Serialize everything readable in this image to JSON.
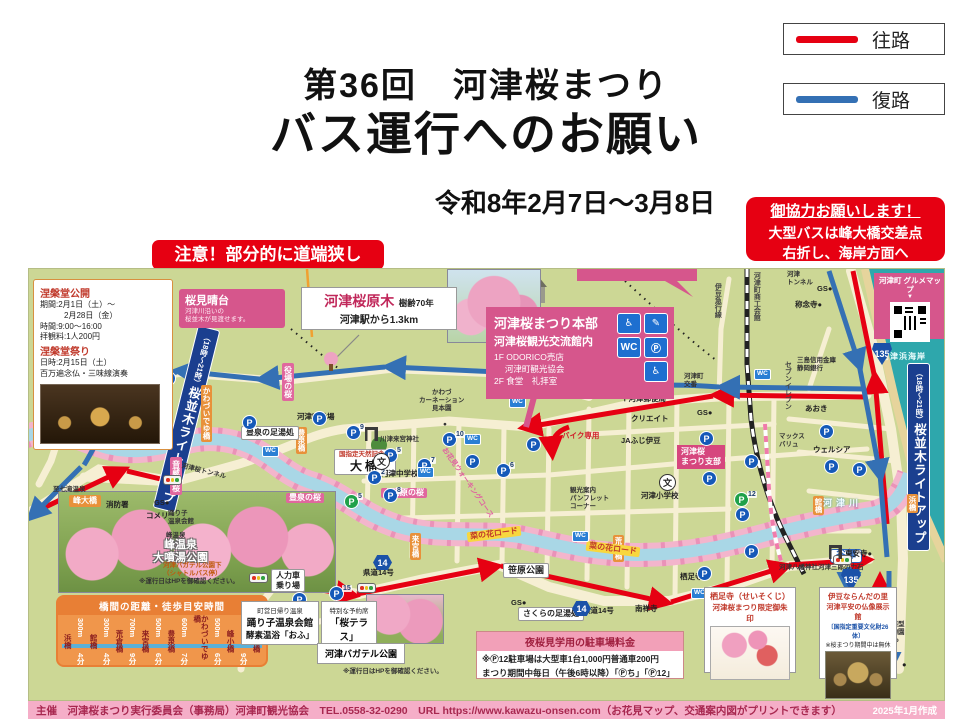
{
  "header": {
    "title_line1": "第36回　河津桜まつり",
    "title_line2": "バス運行へのお願い",
    "period": "令和8年2月7日～3月8日",
    "legend": [
      {
        "label": "往路",
        "color": "#e60012"
      },
      {
        "label": "復路",
        "color": "#3470b4"
      }
    ],
    "notice_right_line1": "御協力お願いします！",
    "notice_right_line2": "大型バスは峰大橋交差点",
    "notice_right_line3": "右折し、海岸方面へ",
    "notice_left": "注意！部分的に道端狭し"
  },
  "map": {
    "parking_glyph": "P",
    "wc_glyph": "WC",
    "school_glyph": "文",
    "route_out_color": "#e60012",
    "route_back_color": "#3470b4",
    "nehando": {
      "title1": "涅槃堂公開",
      "body1": "期間:2月1日（土）～\n　　　2月28日（金）\n時間:9:00～16:00\n拝観料:1人200円",
      "title2": "涅槃堂祭り",
      "body2": "日時:2月15日（土）\n百万遍念仏・三味線演奏"
    },
    "miharashi": {
      "title": "桜見晴台",
      "sub": "河津川沿いの\n桜並木が見渡せます。"
    },
    "genboku": {
      "name": "河津桜原木",
      "age": "樹齢70年",
      "sub": "河津駅から1.3km"
    },
    "hombu": {
      "line1": "河津桜まつり本部",
      "line2": "河津桜観光交流館内",
      "line3": "1F ODORICO売店\n　 河津町観光協会\n2F 食堂　礼拝室",
      "icons": [
        {
          "g": "♿"
        },
        {
          "g": "✎"
        },
        {
          "g": "WC"
        },
        {
          "g": "Ⓟ"
        },
        {
          "g": "♿"
        }
      ]
    },
    "gurume": {
      "title": "河津町\nグルメマップ",
      "arrow": "▼"
    },
    "feebox": {
      "header": "夜桜見学用の駐車場料金",
      "line1": "※Ⓟ12駐車場は大型車1台1,000円普通車200円",
      "line2": "まつり期間中毎日（午後6時以降）「Ⓟち」「Ⓟ12」"
    },
    "seisokuji": {
      "line1": "栖足寺（せいそくじ）",
      "line2": "河津桜まつり限定御朱印"
    },
    "naranda": {
      "line1": "伊豆ならんだの里",
      "line2": "河津平安の仏像展示館",
      "line3": "〔国指定重要文化財26体〕",
      "line4": "※桜まつり期間中は無休"
    },
    "odoriko": {
      "line1": "町営日帰り温泉",
      "line2": "踊り子温泉会館",
      "line3": "酵素温浴「おふ」"
    },
    "terrace": {
      "line1": "特別な予約席",
      "line2": "「桜テラス」"
    },
    "bagatel_label": "河津バガテル公園",
    "labels": [
      {
        "t": "涅槃堂",
        "x": 112,
        "y": 74,
        "cls": "vplain"
      },
      {
        "pre": "（18時～21時）",
        "t": "桜並木ライトアップ",
        "x": 146,
        "y": 56,
        "cls": "bluebox",
        "rot": "rotate(14deg)"
      },
      {
        "pre": "（18時～21時）",
        "t": "桜並木ライトアップ",
        "x": 878,
        "y": 94,
        "cls": "bluebox"
      },
      {
        "t": "峰小橋",
        "x": 20,
        "y": 157,
        "cls": "orangeh"
      },
      {
        "t": "峰大橋",
        "x": 40,
        "y": 226,
        "cls": "orangeh"
      },
      {
        "t": "かわづいでゆ橋",
        "x": 172,
        "y": 116,
        "cls": "orangev"
      },
      {
        "t": "豊泉橋",
        "x": 267,
        "y": 158,
        "cls": "orangev"
      },
      {
        "t": "来宮橋",
        "x": 381,
        "y": 264,
        "cls": "orangev"
      },
      {
        "t": "荒倉橋",
        "x": 584,
        "y": 266,
        "cls": "orangev"
      },
      {
        "t": "館橋",
        "x": 784,
        "y": 227,
        "cls": "orangev"
      },
      {
        "t": "浜橋",
        "x": 878,
        "y": 225,
        "cls": "orangev"
      },
      {
        "t": "役場の桜",
        "x": 253,
        "y": 94,
        "cls": "pinkv"
      },
      {
        "t": "音蔵の桜",
        "x": 141,
        "y": 188,
        "cls": "pinkv"
      },
      {
        "t": "上河原の桜",
        "x": 352,
        "y": 219,
        "cls": "pinkh"
      },
      {
        "t": "豊泉の桜",
        "x": 257,
        "y": 224,
        "cls": "pinkh"
      },
      {
        "t": "河津桜\nまつり支部",
        "x": 648,
        "y": 176,
        "cls": "pinksm"
      },
      {
        "t": "菜の花ロード",
        "x": 438,
        "y": 260,
        "cls": "yellow",
        "rot": "rotate(-7deg)"
      },
      {
        "t": "菜の花ロード",
        "x": 557,
        "y": 275,
        "cls": "yellow",
        "rot": "rotate(7deg)"
      },
      {
        "t": "笹原公園",
        "x": 474,
        "y": 294,
        "cls": "wboxb"
      },
      {
        "t": "さくらの足湯処",
        "x": 489,
        "y": 338,
        "cls": "wboxb s"
      },
      {
        "t": "豊泉の足湯処",
        "x": 212,
        "y": 157,
        "cls": "wboxb s"
      },
      {
        "pre": "国指定天然記念物",
        "t": "大楠",
        "x": 305,
        "y": 180,
        "cls": "kusu"
      },
      {
        "t": "川津来宮神社",
        "x": 351,
        "y": 167,
        "cls": "tiny6"
      },
      {
        "t": "河津中学校",
        "x": 352,
        "y": 200,
        "cls": "tiny"
      },
      {
        "t": "河津小学校",
        "x": 612,
        "y": 222,
        "cls": "tiny"
      },
      {
        "t": "消防署",
        "x": 77,
        "y": 231,
        "cls": "tiny"
      },
      {
        "t": "GS●",
        "x": 125,
        "y": 229,
        "cls": "tiny"
      },
      {
        "t": "コメリ",
        "x": 117,
        "y": 242,
        "cls": "tiny"
      },
      {
        "t": "至七滝温泉",
        "x": 24,
        "y": 217,
        "cls": "tiny6"
      },
      {
        "t": "踊り子\n温泉会館",
        "x": 139,
        "y": 241,
        "cls": "tiny6"
      },
      {
        "t": "峰温泉",
        "x": 137,
        "y": 263,
        "cls": "tiny6"
      },
      {
        "t": "峰温泉\n大噴湯公園",
        "x": 124,
        "y": 270,
        "cls": "parkname"
      },
      {
        "t": "人力車\n乗り場",
        "x": 242,
        "y": 300,
        "cls": "wboxb s"
      },
      {
        "t": "河津バガテル公園下\n（シャトルバス停）",
        "x": 134,
        "y": 293,
        "cls": "tinyorange"
      },
      {
        "t": "※運行日はHPを御確認ください。",
        "x": 110,
        "y": 309,
        "cls": "tiny6"
      },
      {
        "t": "※運行日はHPを御確認ください。",
        "x": 314,
        "y": 399,
        "cls": "tiny6"
      },
      {
        "t": "かわづ\nカーネーション\n見本園",
        "x": 390,
        "y": 120,
        "cls": "tiny6 c"
      },
      {
        "t": "●",
        "x": 414,
        "y": 152,
        "cls": "tiny6"
      },
      {
        "t": "ファミリー\nマート",
        "x": 512,
        "y": 116,
        "cls": "tiny6"
      },
      {
        "t": "バイク専用",
        "x": 533,
        "y": 162,
        "cls": "tiny redb"
      },
      {
        "t": "観光案内\nパンフレット\nコーナー",
        "x": 541,
        "y": 218,
        "cls": "tiny6"
      },
      {
        "t": "クリエイト",
        "x": 602,
        "y": 145,
        "cls": "tiny"
      },
      {
        "t": "JAふじ伊豆",
        "x": 592,
        "y": 167,
        "cls": "tiny"
      },
      {
        "t": "〒河津郵便局",
        "x": 592,
        "y": 125,
        "cls": "tiny"
      },
      {
        "t": "町立図書館\n「文化の家」",
        "x": 588,
        "y": 78,
        "cls": "tiny6"
      },
      {
        "t": "河津町\n交番",
        "x": 655,
        "y": 104,
        "cls": "tiny6"
      },
      {
        "t": "GS●",
        "x": 668,
        "y": 139,
        "cls": "tiny"
      },
      {
        "t": "GS●",
        "x": 482,
        "y": 329,
        "cls": "tiny"
      },
      {
        "t": "三島信用金庫\n静岡銀行",
        "x": 768,
        "y": 88,
        "cls": "tiny6"
      },
      {
        "t": "セブンイレブン",
        "x": 754,
        "y": 92,
        "cls": "vplain"
      },
      {
        "t": "あおき",
        "x": 776,
        "y": 135,
        "cls": "tiny"
      },
      {
        "t": "マックス\nバリュ",
        "x": 750,
        "y": 164,
        "cls": "tiny6"
      },
      {
        "t": "ウェルシア",
        "x": 784,
        "y": 176,
        "cls": "tiny"
      },
      {
        "t": "伊豆急行線",
        "x": 684,
        "y": 14,
        "cls": "vplain"
      },
      {
        "t": "河津町商工会館",
        "x": 723,
        "y": 3,
        "cls": "vplain"
      },
      {
        "t": "河津\nトンネル",
        "x": 758,
        "y": 2,
        "cls": "tiny6"
      },
      {
        "t": "GS●",
        "x": 788,
        "y": 15,
        "cls": "tiny"
      },
      {
        "t": "称念寺●",
        "x": 766,
        "y": 31,
        "cls": "tiny"
      },
      {
        "t": "河津浜海岸",
        "x": 852,
        "y": 83,
        "cls": "sealabel"
      },
      {
        "t": "河津川",
        "x": 794,
        "y": 229,
        "cls": "riverlabel"
      },
      {
        "t": "谷津",
        "x": 801,
        "y": 280,
        "cls": "bluelabel"
      },
      {
        "t": "至下田",
        "x": 805,
        "y": 348,
        "cls": "vplain"
      },
      {
        "t": "体感型\n動物園\niZoo",
        "x": 856,
        "y": 352,
        "cls": "tiny6"
      },
      {
        "t": "●",
        "x": 873,
        "y": 391,
        "cls": "tiny"
      },
      {
        "t": "東安寺●",
        "x": 816,
        "y": 280,
        "cls": "tiny"
      },
      {
        "t": "河津八幡神社河津三郎の力石",
        "x": 750,
        "y": 295,
        "cls": "tiny6"
      },
      {
        "t": "栖足寺",
        "x": 651,
        "y": 303,
        "cls": "tiny"
      },
      {
        "t": "南禅寺",
        "x": 606,
        "y": 335,
        "cls": "tiny"
      },
      {
        "t": "県道14号",
        "x": 334,
        "y": 299,
        "cls": "tiny"
      },
      {
        "t": "県道14号",
        "x": 554,
        "y": 337,
        "cls": "tiny"
      },
      {
        "t": "河津町役場",
        "x": 268,
        "y": 143,
        "cls": "tiny"
      },
      {
        "t": "河津桜トンネル",
        "x": 152,
        "y": 199,
        "cls": "tiny6",
        "rot": "rotate(14deg)"
      },
      {
        "t": "お花見ウォーキングコース",
        "x": 396,
        "y": 210,
        "cls": "walkc",
        "rot": "rotate(55deg)"
      }
    ],
    "parking": [
      {
        "x": 96,
        "y": 118
      },
      {
        "x": 132,
        "y": 102
      },
      {
        "x": 213,
        "y": 146
      },
      {
        "x": 283,
        "y": 142
      },
      {
        "x": 317,
        "y": 156,
        "n": "9"
      },
      {
        "x": 413,
        "y": 163,
        "n": "10"
      },
      {
        "x": 354,
        "y": 179,
        "n": "5"
      },
      {
        "x": 338,
        "y": 201,
        "n": "2"
      },
      {
        "x": 354,
        "y": 219,
        "n": "8"
      },
      {
        "x": 388,
        "y": 189,
        "n": "7"
      },
      {
        "x": 436,
        "y": 185
      },
      {
        "x": 467,
        "y": 194,
        "n": "6"
      },
      {
        "x": 497,
        "y": 168
      },
      {
        "x": 670,
        "y": 162
      },
      {
        "x": 715,
        "y": 185
      },
      {
        "x": 673,
        "y": 202
      },
      {
        "x": 706,
        "y": 238
      },
      {
        "x": 715,
        "y": 275
      },
      {
        "x": 795,
        "y": 190
      },
      {
        "x": 823,
        "y": 193
      },
      {
        "x": 790,
        "y": 155
      },
      {
        "x": 668,
        "y": 297
      },
      {
        "x": 300,
        "y": 317,
        "n": "15"
      },
      {
        "x": 263,
        "y": 323
      },
      {
        "x": 223,
        "y": 370
      },
      {
        "x": 103,
        "y": 373
      },
      {
        "x": 705,
        "y": 223,
        "n": "12",
        "cls": "g"
      },
      {
        "x": 315,
        "y": 225,
        "n": "5",
        "cls": "g"
      }
    ],
    "wc": [
      {
        "x": 63,
        "y": 133
      },
      {
        "x": 233,
        "y": 177
      },
      {
        "x": 435,
        "y": 165
      },
      {
        "x": 388,
        "y": 198
      },
      {
        "x": 480,
        "y": 128
      },
      {
        "x": 543,
        "y": 262
      },
      {
        "x": 725,
        "y": 100
      },
      {
        "x": 662,
        "y": 319
      }
    ],
    "traffic_lights": [
      {
        "x": 134,
        "y": 206
      },
      {
        "x": 220,
        "y": 304
      },
      {
        "x": 328,
        "y": 314
      },
      {
        "x": 804,
        "y": 286
      }
    ],
    "shields": [
      {
        "n": "135",
        "x": 843,
        "y": 74,
        "cls": "s135"
      },
      {
        "n": "135",
        "x": 812,
        "y": 300,
        "cls": "s135"
      },
      {
        "n": "14",
        "x": 344,
        "y": 286,
        "cls": "s14"
      },
      {
        "n": "14",
        "x": 543,
        "y": 332,
        "cls": "s14"
      }
    ],
    "schools": [
      {
        "x": 344,
        "y": 184
      },
      {
        "x": 630,
        "y": 205
      }
    ],
    "torii": [
      {
        "x": 336,
        "y": 158
      },
      {
        "x": 800,
        "y": 276
      }
    ]
  },
  "bridge_table": {
    "title": "橋間の距離・徒歩目安時間",
    "cells": [
      {
        "b": "浜橋"
      },
      {
        "d": "300m",
        "m": "4分"
      },
      {
        "b": "館橋"
      },
      {
        "d": "300m",
        "m": "4分"
      },
      {
        "b": "荒倉橋"
      },
      {
        "d": "700m",
        "m": "9分"
      },
      {
        "b": "来宮橋"
      },
      {
        "d": "500m",
        "m": "6分"
      },
      {
        "b": "豊泉橋"
      },
      {
        "d": "600m",
        "m": "7分"
      },
      {
        "b": "かわづいでゆ橋"
      },
      {
        "d": "500m",
        "m": "6分"
      },
      {
        "b": "峰小橋"
      },
      {
        "d": "700m",
        "m": "9分"
      },
      {
        "b": "峰大橋"
      }
    ]
  },
  "footer": {
    "credit": "主催　河津桜まつり実行委員会（事務局）河津町観光協会　TEL.0558-32-0290　URL https://www.kawazu-onsen.com（お花見マップ、交通案内図がプリントできます）",
    "made": "2025年1月作成"
  }
}
